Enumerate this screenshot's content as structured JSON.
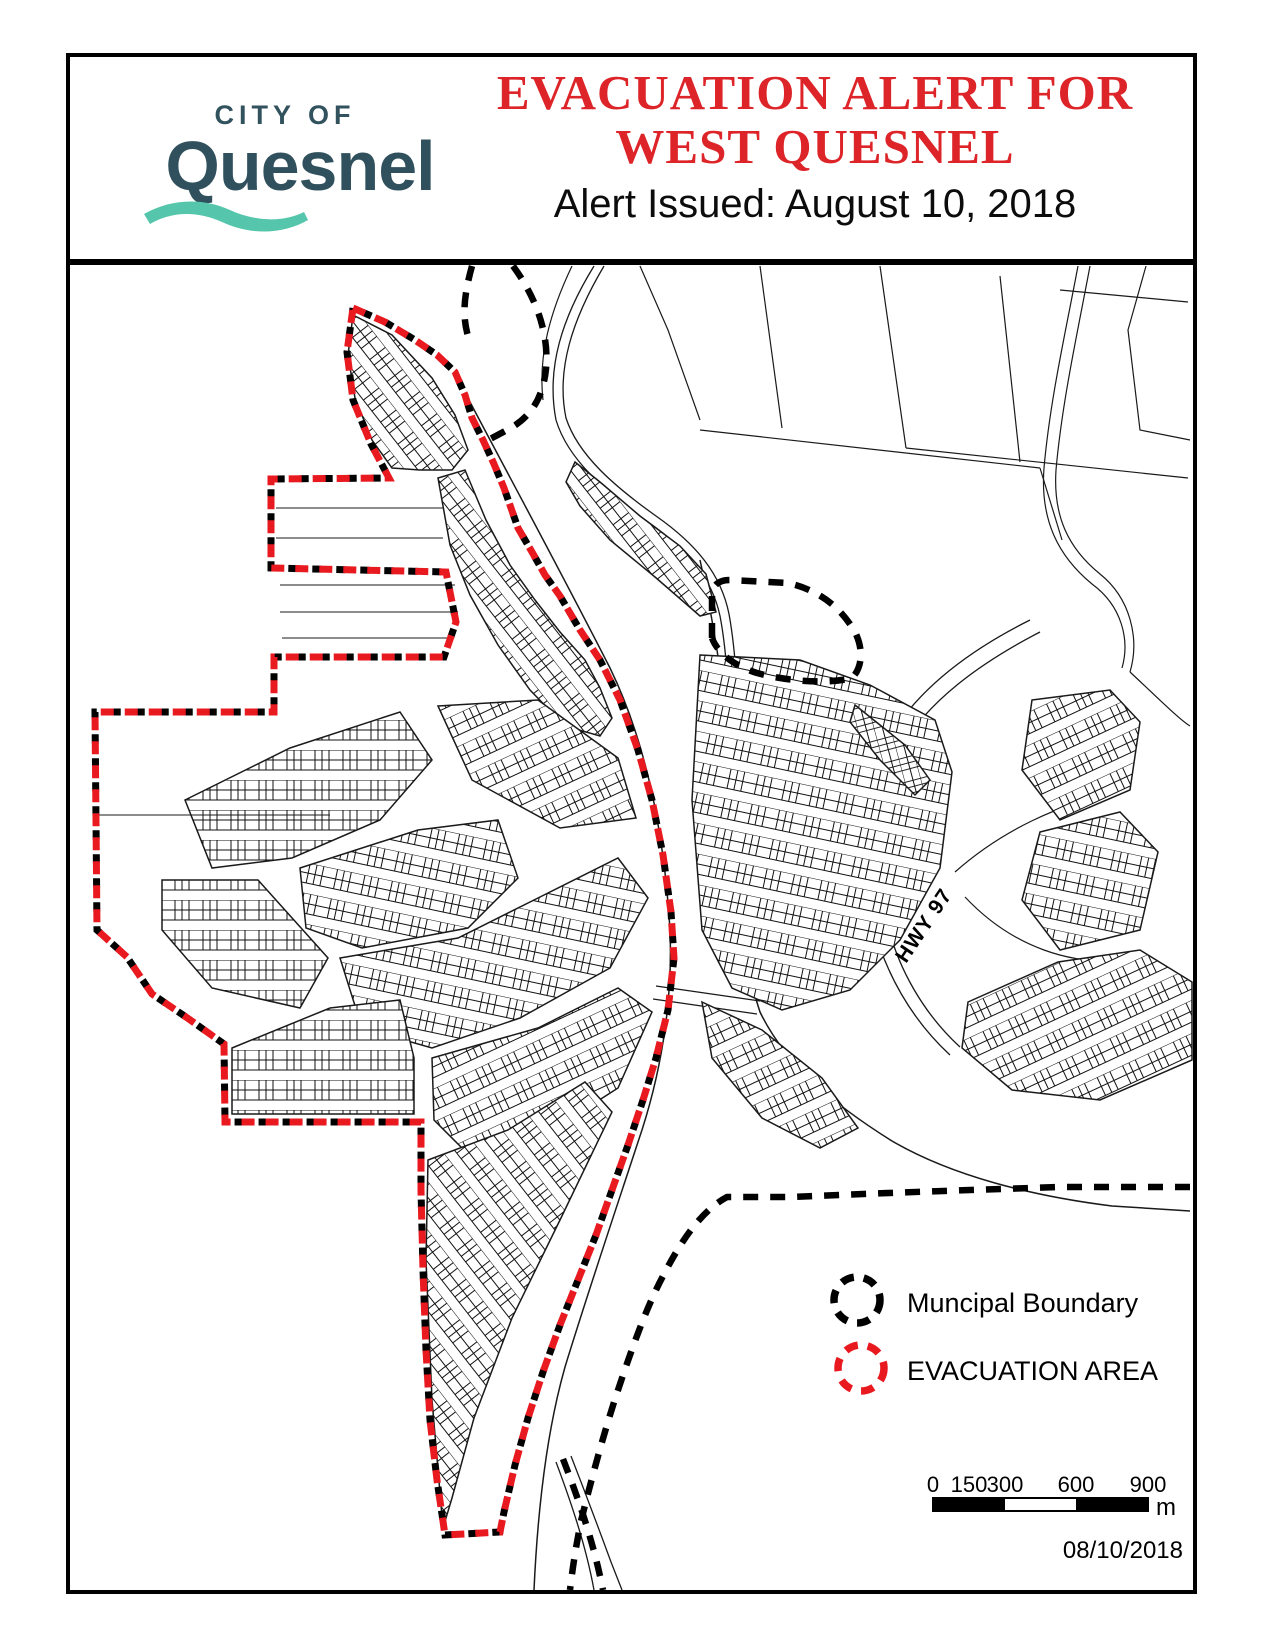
{
  "page": {
    "background": "#ffffff",
    "border_color": "#000000"
  },
  "header": {
    "logo": {
      "tagline": "CITY OF",
      "name": "Quesnel",
      "text_color": "#32525E",
      "wave_color": "#55C6AB"
    },
    "title_line1": "EVACUATION ALERT FOR",
    "title_line2": "WEST QUESNEL",
    "title_color": "#DD2428",
    "subtitle": "Alert Issued: August 10, 2018"
  },
  "map": {
    "highway_label": "HWY 97",
    "legend": {
      "municipal": {
        "label": "Muncipal Boundary",
        "color": "#000000"
      },
      "evacuation": {
        "label": "EVACUATION AREA",
        "color": "#E8191F"
      }
    },
    "scale_bar": {
      "ticks": [
        "0",
        "150",
        "300",
        "600",
        "900"
      ],
      "unit": "m"
    },
    "date": "08/10/2018",
    "evacuation_color": "#E8191F",
    "boundary_color": "#000000"
  }
}
